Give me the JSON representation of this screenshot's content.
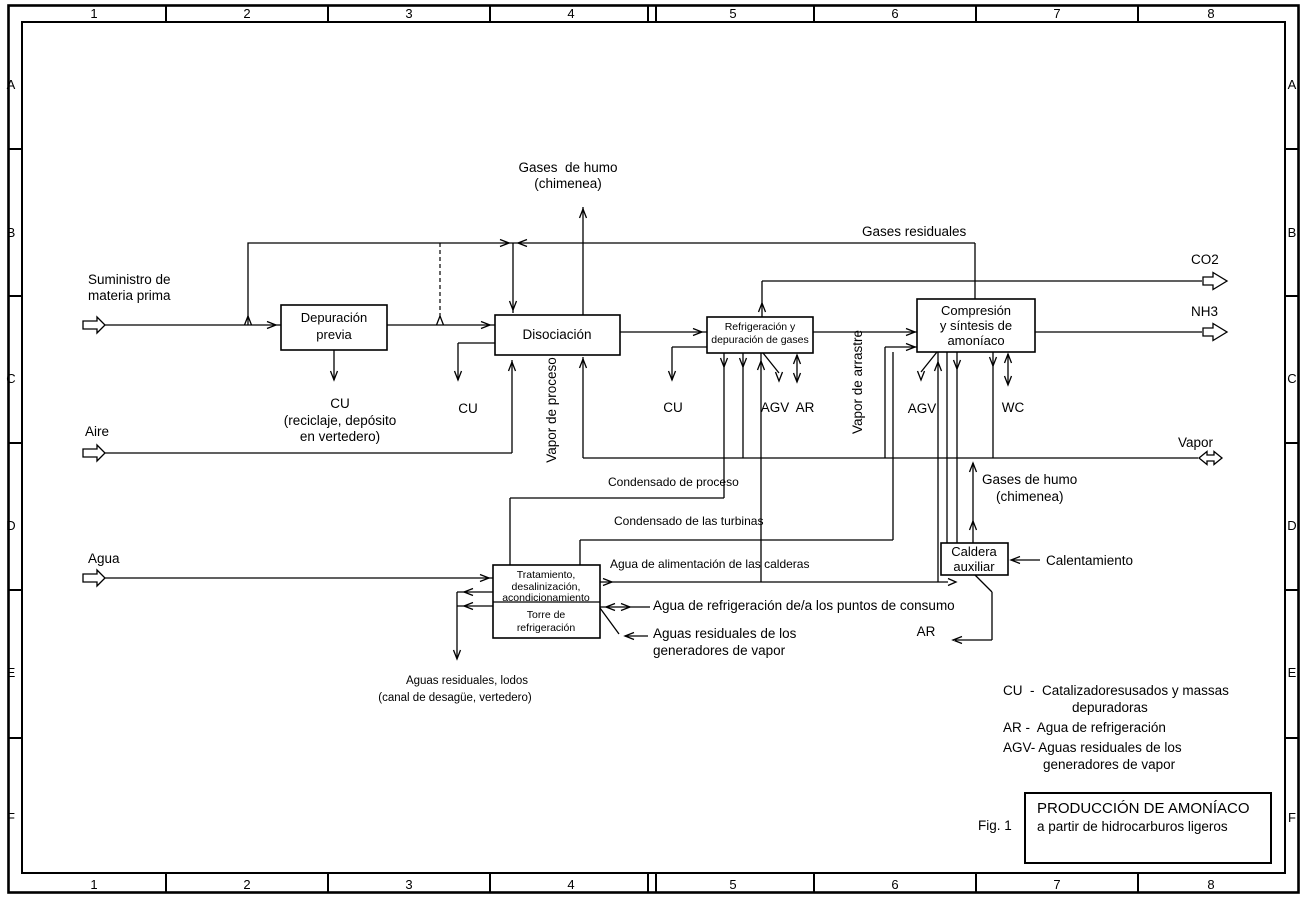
{
  "frame": {
    "columns": [
      "1",
      "2",
      "3",
      "4",
      "5",
      "6",
      "7",
      "8"
    ],
    "rows": [
      "A",
      "B",
      "C",
      "D",
      "E",
      "F"
    ]
  },
  "sources": {
    "suministro_1": "Suministro de",
    "suministro_2": "materia prima",
    "aire": "Aire",
    "agua": "Agua"
  },
  "boxes": {
    "depuracion_1": "Depuración",
    "depuracion_2": "previa",
    "disociacion": "Disociación",
    "refrigeracion_1": "Refrigeración y",
    "refrigeracion_2": "depuración de gases",
    "compresion_1": "Compresión",
    "compresion_2": "y síntesis de",
    "compresion_3": "amoníaco",
    "caldera_1": "Caldera",
    "caldera_2": "auxiliar",
    "tratamiento_1": "Tratamiento,",
    "tratamiento_2": "desalinización,",
    "tratamiento_3": "acondicionamiento",
    "torre_1": "Torre de",
    "torre_2": "refrigeración"
  },
  "streams": {
    "gases_humo_1": "Gases  de humo",
    "gases_humo_2": "(chimenea)",
    "gases_residuales": "Gases residuales",
    "co2": "CO2",
    "nh3": "NH3",
    "vapor": "Vapor",
    "vapor_proceso": "Vapor de proceso",
    "vapor_arrastre": "Vapor de arrastre",
    "cu_dep": "CU",
    "cu_dep_nota_1": "(reciclaje, depósito",
    "cu_dep_nota_2": "en vertedero)",
    "cu_disoc": "CU",
    "cu_refrig": "CU",
    "agv_refrig": "AGV",
    "ar_refrig": "AR",
    "agv_compr": "AGV",
    "wc": "WC",
    "cond_proceso": "Condensado de proceso",
    "cond_turbinas": "Condensado de las turbinas",
    "agua_calderas": "Agua de alimentación de las calderas",
    "agua_refrig_consumo": "Agua de refrigeración de/a los puntos de consumo",
    "aguas_resid_gen_1": "Aguas residuales de los",
    "aguas_resid_gen_2": "generadores de vapor",
    "gases_humo_caldera_1": "Gases de humo",
    "gases_humo_caldera_2": "(chimenea)",
    "calentamiento": "Calentamiento",
    "ar_caldera": "AR",
    "aguas_lodos_1": "Aguas residuales, lodos",
    "aguas_lodos_2": "(canal de desagüe, vertedero)"
  },
  "legend": {
    "cu_line1": "CU  -  Catalizadoresusados y massas",
    "cu_line2": "depuradoras",
    "ar_line": "AR -  Agua de refrigeración",
    "agv_line1": "AGV- Aguas residuales de los",
    "agv_line2": "generadores de vapor"
  },
  "title_block": {
    "fig": "Fig. 1",
    "title_1": "PRODUCCIÓN DE AMONÍACO",
    "title_2": "a partir de hidrocarburos ligeros"
  }
}
